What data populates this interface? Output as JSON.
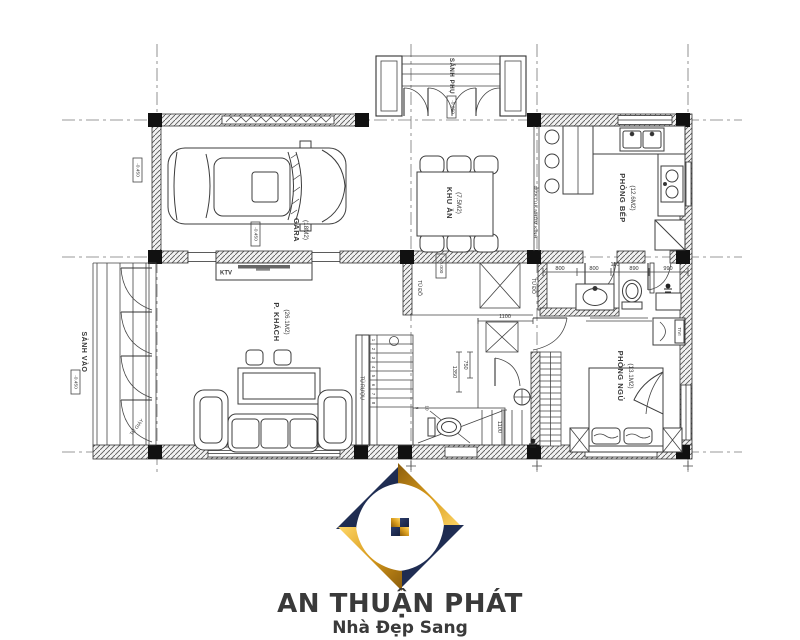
{
  "plan": {
    "rooms": {
      "garage": {
        "name": "GARA",
        "area": "(18M2)"
      },
      "dining": {
        "name": "KHU ĂN",
        "area": "(7.5M2)"
      },
      "kitchen": {
        "name": "PHÒNG BẾP",
        "area": "(12.6M2)"
      },
      "living": {
        "name": "P. KHÁCH",
        "area": "(26.1M2)"
      },
      "bedroom": {
        "name": "PHÒNG NGỦ",
        "area": "(13.1M2)"
      },
      "entry_hall": {
        "name": "SẢNH VÀO"
      },
      "side_porch": {
        "name": "SẢNH PHỤ"
      }
    },
    "fixtures": {
      "ktv": "KTV",
      "wine_cabinet": "TỦ RƯỢU",
      "closet": "TỦ ĐỒ",
      "tv": "TIVI",
      "shoe_cabinet": "TỦ GIÀY",
      "sliding_door": "CỬA LÙA NHÔM KÍNH"
    },
    "elevations": {
      "ground": "±0.000",
      "garage": "-0.450",
      "drive": "-0.450",
      "entry": "-0.450",
      "porch": "-0.050"
    },
    "dims": {
      "d1": "800",
      "d2": "800",
      "d3": "110",
      "d4": "890",
      "d5": "990",
      "door": "1100",
      "stair": "1100",
      "wc_w": "750",
      "wc_d": "1350"
    },
    "stairs": {
      "n1": "1",
      "n2": "2",
      "n3": "3",
      "n4": "4",
      "n5": "5",
      "n6": "6",
      "n7": "7",
      "n8": "8",
      "n9": "9",
      "n10": "10"
    }
  },
  "logo": {
    "title": "AN THUẬN PHÁT",
    "tagline": "Nhà Đẹp Sang",
    "gold": "#D79A1B",
    "navy": "#1C2B50"
  }
}
